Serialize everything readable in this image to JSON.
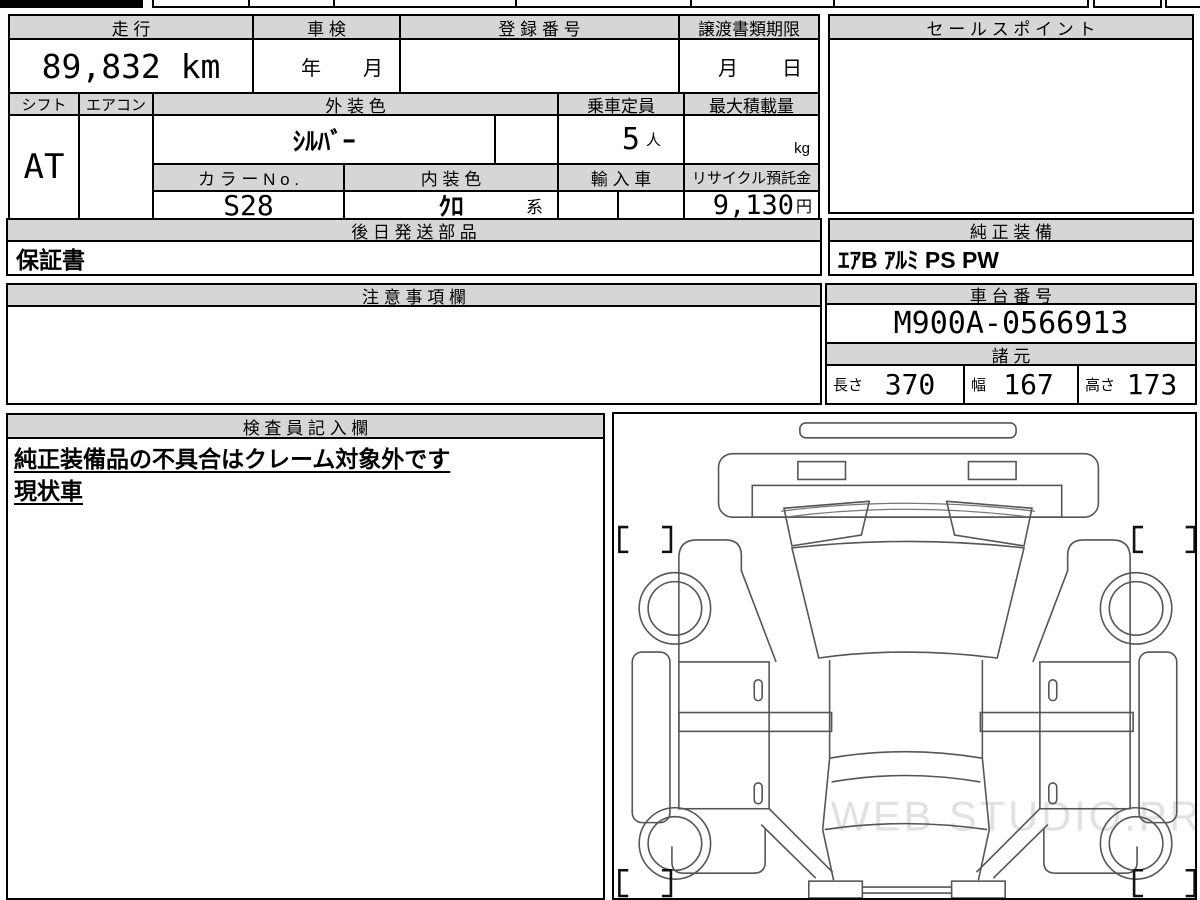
{
  "table1": {
    "headers": {
      "mileage": "走 行",
      "inspection": "車 検",
      "registration": "登 録 番 号",
      "transfer_docs": "譲渡書類期限"
    },
    "values": {
      "mileage": "89,832 km",
      "inspection_year": "年",
      "inspection_month": "月",
      "transfer_month": "月",
      "transfer_day": "日"
    }
  },
  "table2": {
    "headers": {
      "shift": "シフト",
      "aircon": "エアコン",
      "exterior_color": "外 装 色",
      "capacity": "乗車定員",
      "max_load": "最大積載量",
      "color_no": "カ ラ ー N o .",
      "interior_color": "内 装 色",
      "import_car": "輸 入 車",
      "recycle_deposit": "リサイクル預託金"
    },
    "values": {
      "shift": "AT",
      "exterior_color": "ｼﾙﾊﾞｰ",
      "capacity_num": "5",
      "capacity_unit": "人",
      "max_load_unit": "kg",
      "color_no": "S28",
      "interior_color": "ｸﾛ",
      "interior_suffix": "系",
      "recycle_num": "9,130",
      "recycle_unit": "円"
    }
  },
  "later_parts": {
    "header": "後 日 発 送 部 品",
    "value": "保証書"
  },
  "genuine_equipment": {
    "header": "純 正 装 備",
    "value": "ｴｱB ｱﾙﾐ PS PW"
  },
  "sales_point": {
    "header": "セ ー ル ス ポ イ ン ト",
    "value": ""
  },
  "notes": {
    "header": "注 意 事 項 欄",
    "value": ""
  },
  "chassis": {
    "header": "車 台 番 号",
    "value": "M900A-0566913"
  },
  "specs": {
    "header": "諸 元",
    "length_label": "長さ",
    "length": "370",
    "width_label": "幅",
    "width": "167",
    "height_label": "高さ",
    "height": "173"
  },
  "inspector": {
    "header": "検 査 員 記 入 欄",
    "line1": "純正装備品の不具合はクレーム対象外です",
    "line2": "現状車"
  },
  "diagram": {
    "watermark": "WEB STUDIO.PRO"
  }
}
